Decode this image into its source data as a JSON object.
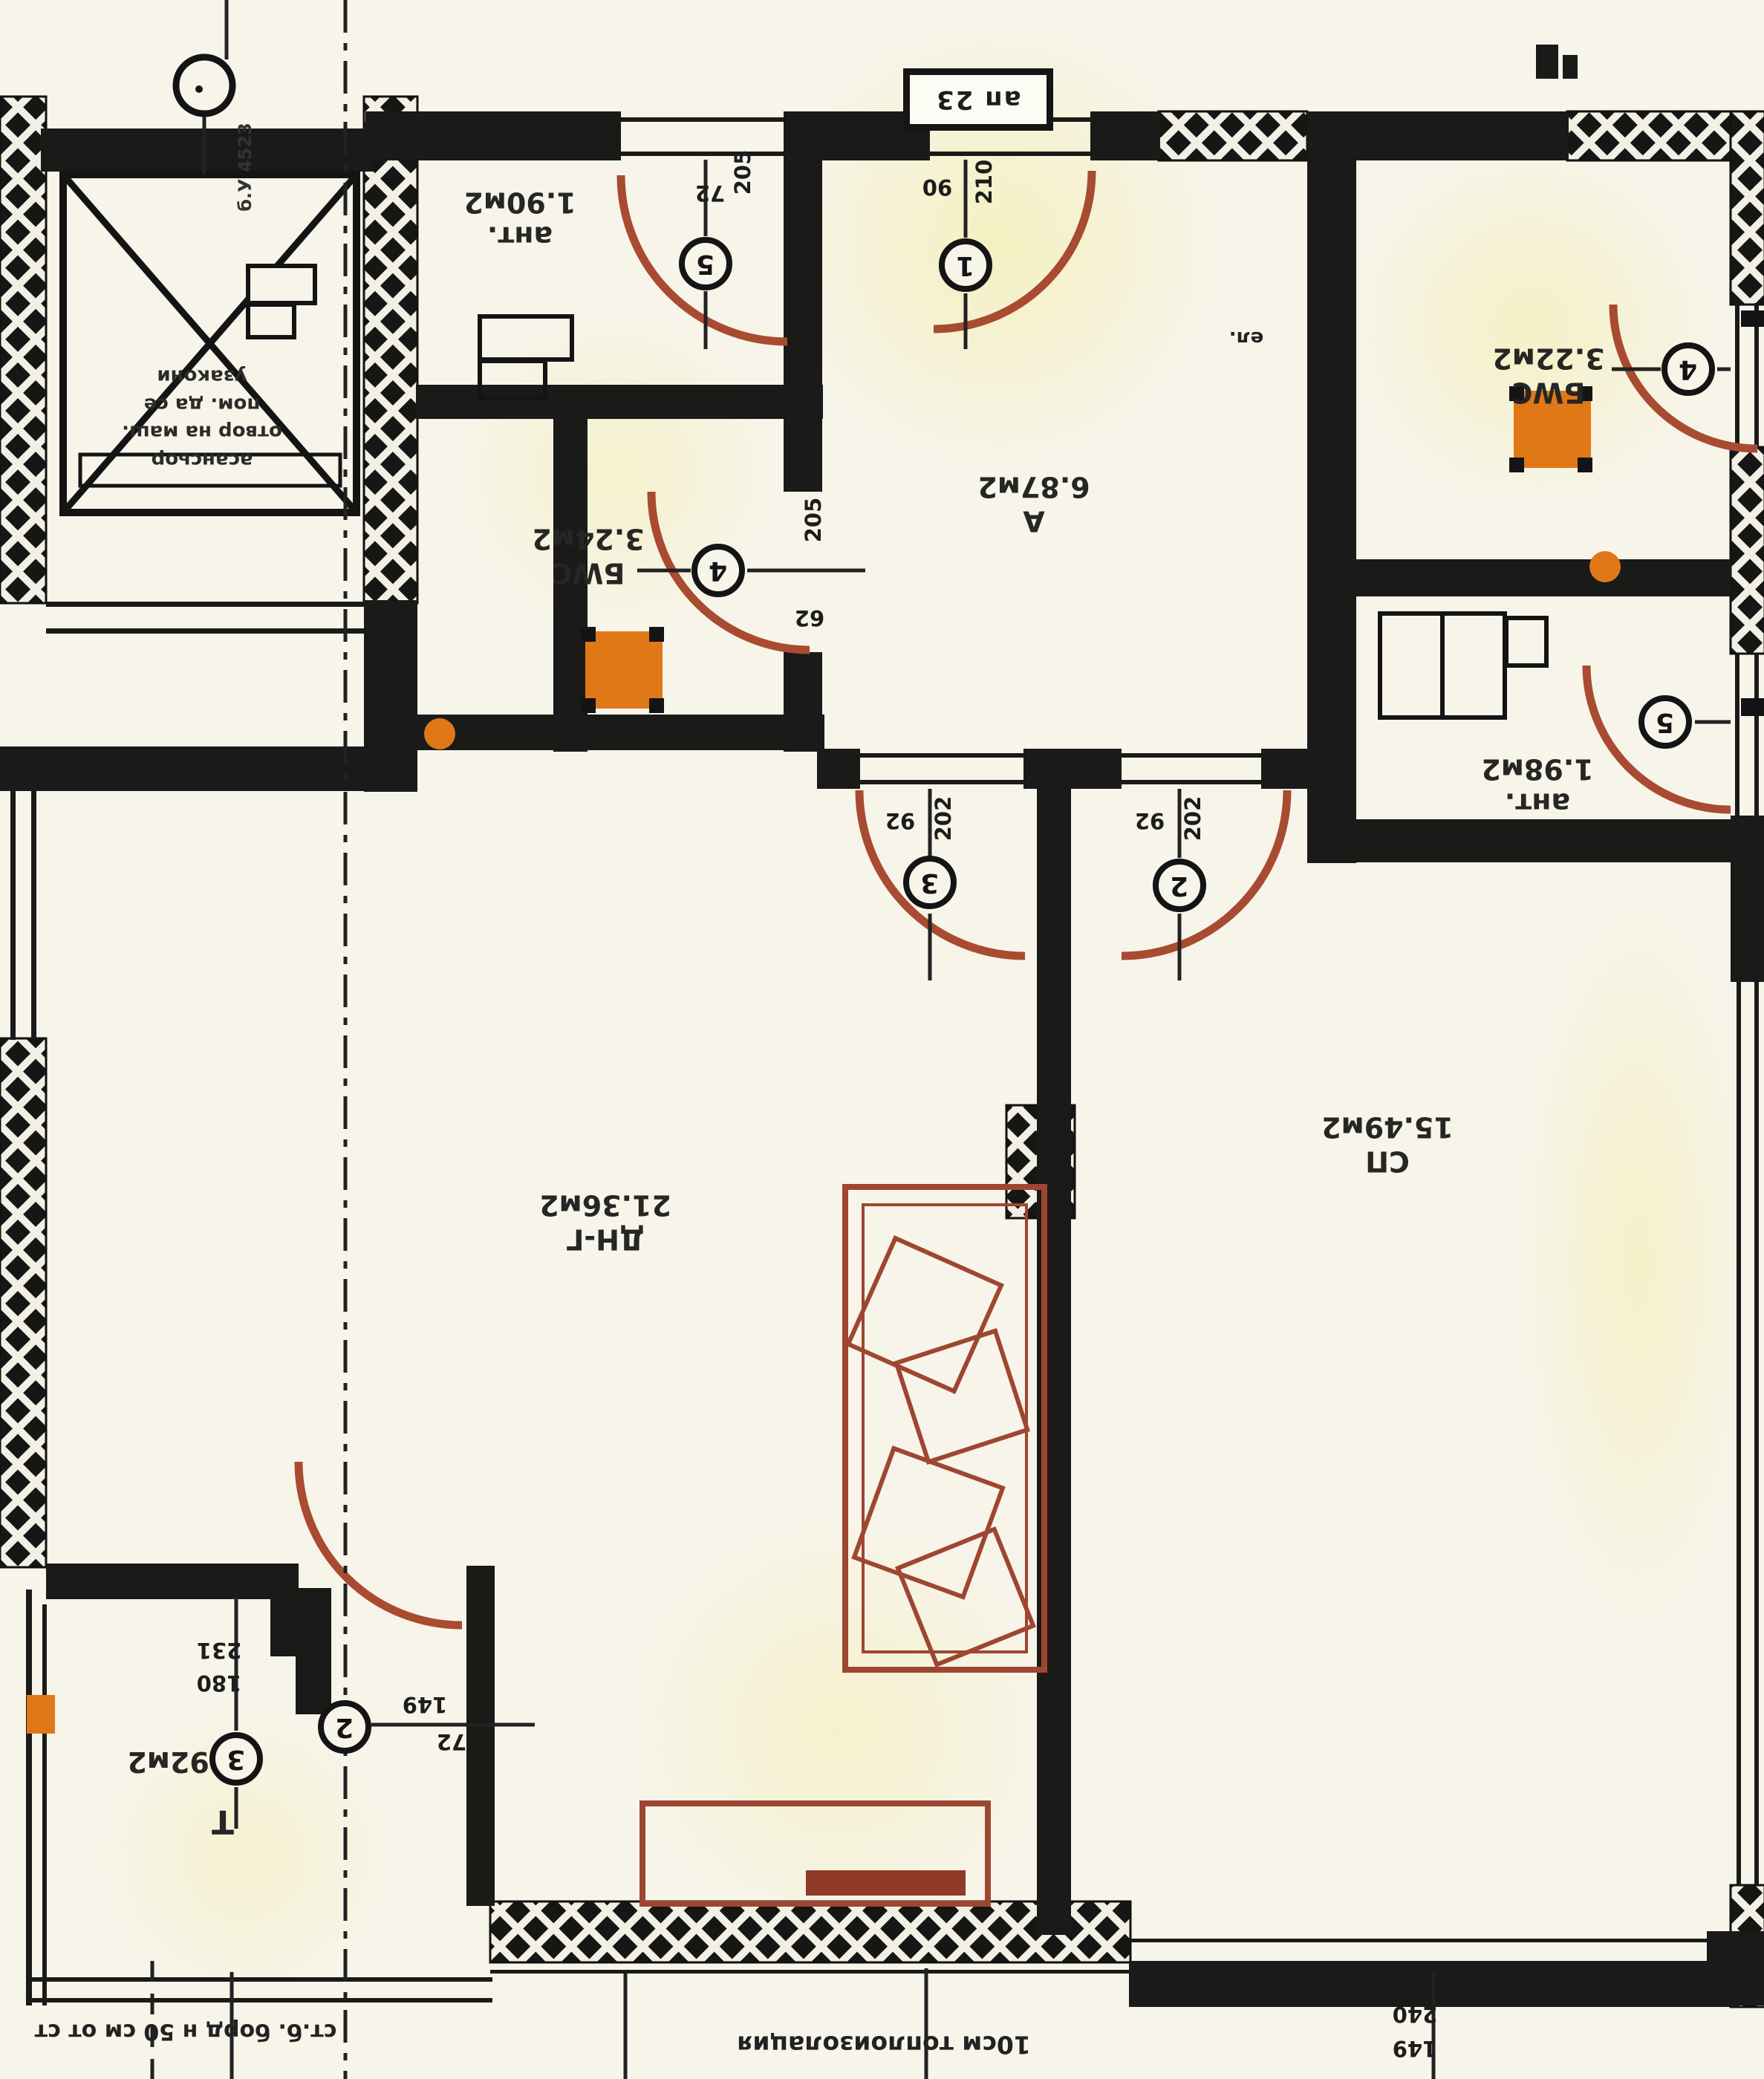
{
  "palette": {
    "paper": "#f7f4ea",
    "ink": "#1d1d1b",
    "door_red": "#a84b30",
    "furniture_red": "#9e4631",
    "orange": "#e07818",
    "highlight": "#f3eda0"
  },
  "title_box": {
    "label": "ап 23"
  },
  "rooms": {
    "hall": {
      "label": "А",
      "area": "6.87м2"
    },
    "living": {
      "label": "ДН-Г",
      "area": "21.36м2"
    },
    "bedroom": {
      "label": "СП",
      "area": "15.49м2"
    },
    "bath_left": {
      "label": "БWC",
      "area": "3.24м2"
    },
    "bath_right": {
      "label": "БWC",
      "area": "3.22м2"
    },
    "entry_left": {
      "label": "ант.",
      "area": "1.90м2"
    },
    "entry_right": {
      "label": "ант.",
      "area": "1.98м2"
    },
    "terrace": {
      "label": "Т",
      "area": "3.92м2"
    }
  },
  "doors": {
    "d1": {
      "num": "1",
      "w": "90",
      "h": "210"
    },
    "d2": {
      "num": "2",
      "w": "92",
      "h": "202"
    },
    "d3": {
      "num": "3",
      "w": "92",
      "h": "202"
    },
    "d4_left": {
      "num": "4",
      "w": "62",
      "h": "205"
    },
    "d4_right": {
      "num": "4"
    },
    "d5_left": {
      "num": "5",
      "w": "72",
      "h": "205"
    },
    "d5_right": {
      "num": "5"
    }
  },
  "markers": {
    "terrace_window": {
      "num": "3"
    },
    "section": {
      "num": "2"
    }
  },
  "dimensions": {
    "terrace_door_w": "180",
    "terrace_door_h": "231",
    "terrace_a": "149",
    "terrace_b": "72",
    "bottom_right_a": "240",
    "bottom_right_b": "149"
  },
  "notes": {
    "elevator_lines": [
      "асансьор",
      "отвор на маш.",
      "пом. да се",
      "узакони"
    ],
    "bottom_center": "10см топлоизолация",
    "bottom_left": "ст.б. борд н 50 см от ст",
    "riser": "б.У 4523",
    "electro": "ел."
  }
}
